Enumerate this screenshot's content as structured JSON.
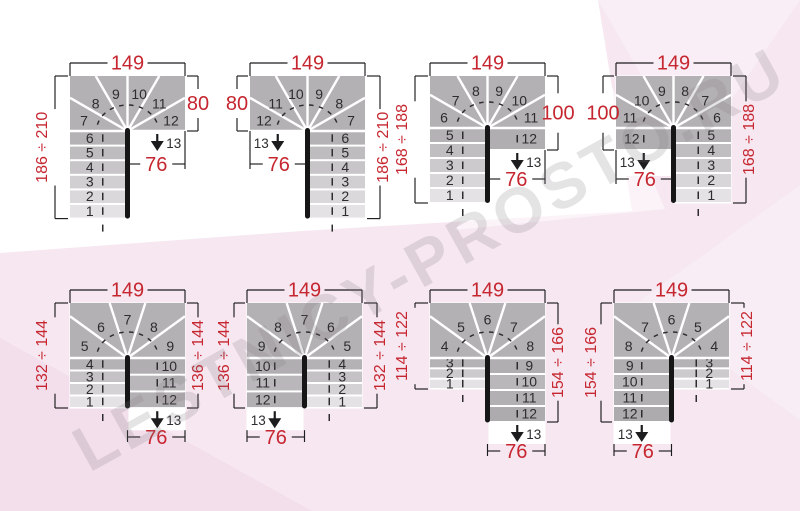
{
  "watermark": "LESTNICY-PROSTO.RU",
  "colors": {
    "red": "#c62630",
    "ink": "#1c1b1d",
    "step_number": "#2e2c2f",
    "winder_gray": "#b4b1b4",
    "newel_black": "#161616",
    "white": "#ffffff",
    "pink_base": "#f6e7f0",
    "pink_deep": "#f0d5e6",
    "pink_corner": "#f9eef5"
  },
  "diagrams": [
    {
      "name": "quarter-turn-13-steps-exit-right",
      "geometry_type": "A",
      "mirror": false,
      "labels": {
        "top": "149",
        "entry": "186 ÷ 210",
        "exit_side": "80",
        "exit": "76"
      },
      "steps": {
        "entry": [
          1,
          2,
          3,
          4,
          5,
          6
        ],
        "winders": [
          7,
          8,
          9,
          10,
          11,
          12
        ],
        "exit_col": [],
        "last": 13
      }
    },
    {
      "name": "quarter-turn-13-steps-exit-left",
      "geometry_type": "A",
      "mirror": true,
      "labels": {
        "top": "149",
        "entry": "186 ÷ 210",
        "exit_side": "80",
        "exit": "76"
      },
      "steps": {
        "entry": [
          1,
          2,
          3,
          4,
          5,
          6
        ],
        "winders": [
          7,
          8,
          9,
          10,
          11,
          12
        ],
        "exit_col": [],
        "last": 13
      }
    },
    {
      "name": "quarter-turn-13-steps-exit-right-tall",
      "geometry_type": "B",
      "mirror": false,
      "labels": {
        "top": "149",
        "entry": "168 ÷ 188",
        "exit_side": "100",
        "exit": "76"
      },
      "steps": {
        "entry": [
          1,
          2,
          3,
          4,
          5
        ],
        "winders": [
          6,
          7,
          8,
          9,
          10,
          11
        ],
        "exit_col": [
          12
        ],
        "last": 13
      }
    },
    {
      "name": "quarter-turn-13-steps-exit-left-tall",
      "geometry_type": "B",
      "mirror": true,
      "labels": {
        "top": "149",
        "entry": "168 ÷ 188",
        "exit_side": "100",
        "exit": "76"
      },
      "steps": {
        "entry": [
          1,
          2,
          3,
          4,
          5
        ],
        "winders": [
          6,
          7,
          8,
          9,
          10,
          11
        ],
        "exit_col": [
          12
        ],
        "last": 13
      }
    },
    {
      "name": "half-turn-13-steps-exit-right",
      "geometry_type": "C",
      "mirror": false,
      "labels": {
        "top": "149",
        "entry": "132 ÷ 144",
        "exit_side": "136 ÷ 144",
        "exit": "76"
      },
      "steps": {
        "entry": [
          1,
          2,
          3,
          4
        ],
        "winders": [
          5,
          6,
          7,
          8,
          9
        ],
        "exit_col": [
          10,
          11,
          12
        ],
        "last": 13
      }
    },
    {
      "name": "half-turn-13-steps-exit-left",
      "geometry_type": "C",
      "mirror": true,
      "labels": {
        "top": "149",
        "entry": "132 ÷ 144",
        "exit_side": "136 ÷ 144",
        "exit": "76"
      },
      "steps": {
        "entry": [
          1,
          2,
          3,
          4
        ],
        "winders": [
          5,
          6,
          7,
          8,
          9
        ],
        "exit_col": [
          10,
          11,
          12
        ],
        "last": 13
      }
    },
    {
      "name": "half-turn-13-steps-exit-right-offset",
      "geometry_type": "D",
      "mirror": false,
      "labels": {
        "top": "149",
        "entry": "114 ÷ 122",
        "exit_side": "154 ÷ 166",
        "exit": "76"
      },
      "steps": {
        "entry": [
          1,
          2,
          3
        ],
        "winders": [
          4,
          5,
          6,
          7,
          8
        ],
        "exit_col": [
          9,
          10,
          11,
          12
        ],
        "last": 13
      }
    },
    {
      "name": "half-turn-13-steps-exit-left-offset",
      "geometry_type": "D",
      "mirror": true,
      "labels": {
        "top": "149",
        "entry": "114 ÷ 122",
        "exit_side": "154 ÷ 166",
        "exit": "76"
      },
      "steps": {
        "entry": [
          1,
          2,
          3
        ],
        "winders": [
          4,
          5,
          6,
          7,
          8
        ],
        "exit_col": [
          9,
          10,
          11,
          12
        ],
        "last": 13
      }
    }
  ]
}
